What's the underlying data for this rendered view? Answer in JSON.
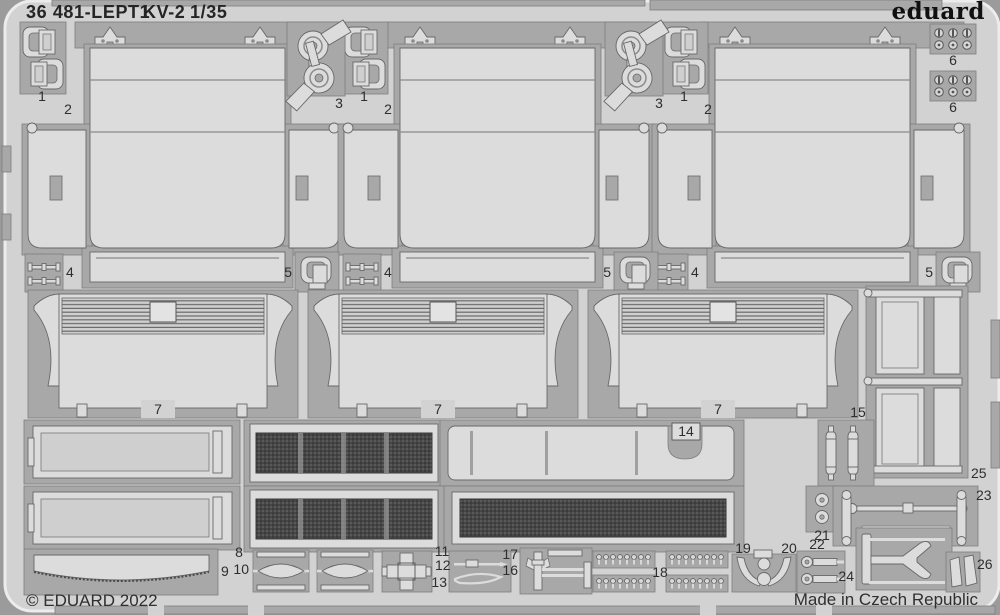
{
  "header": {
    "catalog": "36 481-LEPT1",
    "kit": "KV-2",
    "scale": "1/35",
    "brand": "eduard"
  },
  "footer": {
    "copyright": "© EDUARD 2022",
    "made_in": "Made in Czech Republic"
  },
  "part_labels": {
    "p1": "1",
    "p2": "2",
    "p3": "3",
    "p4": "4",
    "p5": "5",
    "p6": "6",
    "p7": "7",
    "p8": "8",
    "p9": "9",
    "p10": "10",
    "p11": "11",
    "p12": "12",
    "p13": "13",
    "p14": "14",
    "p15": "15",
    "p16": "16",
    "p17": "17",
    "p18": "18",
    "p19": "19",
    "p20": "20",
    "p21": "21",
    "p22": "22",
    "p23": "23",
    "p24": "24",
    "p25": "25",
    "p26": "26"
  },
  "colors": {
    "background": "#9b9b9b",
    "sheet": "#d2d2d2",
    "recess": "#a8a8a8",
    "part": "#dcdcdc",
    "mesh": "#474747",
    "text": "#2e2e2e"
  }
}
